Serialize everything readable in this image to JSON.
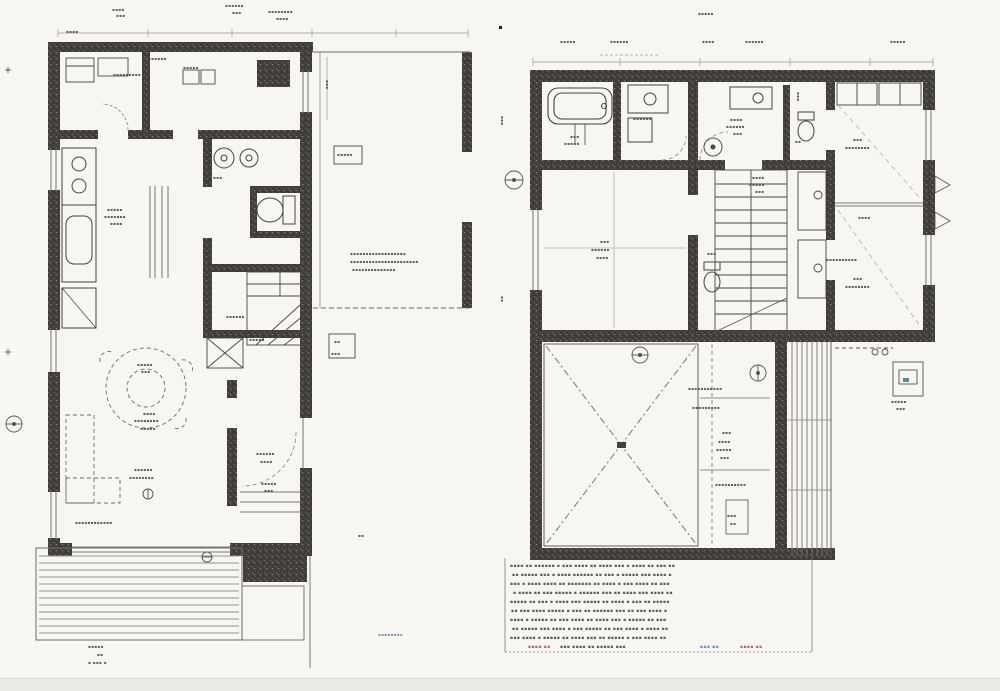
{
  "diagram": {
    "kind": "scanned-architectural-floorplan",
    "plan_count": 2,
    "legible_text": false,
    "left_plan_features": [
      "kitchen-counter",
      "washroom-basins",
      "toilet",
      "winder-stairs",
      "dashed-round-table",
      "sofa",
      "entrance-hall-door-arc",
      "wood-deck",
      "open-carport-bay"
    ],
    "right_plan_features": [
      "bathtub",
      "washstand",
      "hall-basin",
      "wc",
      "tatami-room",
      "straight-stairs",
      "two-bedrooms",
      "closets",
      "void-room-x-brace",
      "balcony-slats",
      "notes-block"
    ]
  },
  "colors": {
    "paper": "#f7f6f2",
    "ink": "#45423e",
    "wall": "#3e3b38",
    "light_line": "#8f8d88",
    "deck_line": "#94928d",
    "note_red": "#a06060",
    "note_blue": "#6b7fae",
    "scan_edge": "#eceae6"
  },
  "illegible_labels": [
    {
      "t": "▪▪▪▪",
      "x": 112,
      "y": 8
    },
    {
      "t": "▪▪▪",
      "x": 116,
      "y": 14
    },
    {
      "t": "▪▪▪▪▪▪",
      "x": 225,
      "y": 4
    },
    {
      "t": "▪▪▪",
      "x": 232,
      "y": 11
    },
    {
      "t": "▪▪▪▪▪▪▪▪",
      "x": 268,
      "y": 10
    },
    {
      "t": "▪▪▪▪",
      "x": 276,
      "y": 17
    },
    {
      "t": "▪▪▪▪",
      "x": 66,
      "y": 30
    },
    {
      "t": "▪▪▪▪▪",
      "x": 70,
      "y": 42
    },
    {
      "t": "▪▪▪▪▪▪",
      "x": 148,
      "y": 57
    },
    {
      "t": "▪▪▪▪▪",
      "x": 183,
      "y": 66
    },
    {
      "t": "▪▪▪▪▪▪▪▪▪",
      "x": 113,
      "y": 73
    },
    {
      "t": "▪▪▪▪▪",
      "x": 107,
      "y": 208
    },
    {
      "t": "▪▪▪▪▪▪▪",
      "x": 104,
      "y": 215
    },
    {
      "t": "▪▪▪▪",
      "x": 110,
      "y": 222
    },
    {
      "t": "▪▪▪",
      "x": 213,
      "y": 176
    },
    {
      "t": "▪▪",
      "x": 250,
      "y": 190
    },
    {
      "t": "▪▪▪▪▪",
      "x": 337,
      "y": 153
    },
    {
      "t": "▪▪▪▪▪▪▪▪▪▪▪▪▪▪▪▪▪▪",
      "x": 350,
      "y": 252
    },
    {
      "t": "▪▪▪▪▪▪▪▪▪▪▪▪▪▪▪▪▪▪▪▪▪▪",
      "x": 350,
      "y": 260
    },
    {
      "t": "▪▪▪▪▪▪▪▪▪▪▪▪▪▪",
      "x": 352,
      "y": 268
    },
    {
      "t": "▪▪▪",
      "x": 329,
      "y": 80,
      "r": 90
    },
    {
      "t": "▪▪",
      "x": 334,
      "y": 340
    },
    {
      "t": "▪▪▪",
      "x": 331,
      "y": 352
    },
    {
      "t": "▪▪▪▪▪▪",
      "x": 226,
      "y": 315
    },
    {
      "t": "▪▪▪▪▪",
      "x": 249,
      "y": 338
    },
    {
      "t": "▪▪▪▪▪",
      "x": 137,
      "y": 363
    },
    {
      "t": "▪▪▪",
      "x": 141,
      "y": 370
    },
    {
      "t": "▪▪▪▪",
      "x": 143,
      "y": 412
    },
    {
      "t": "▪▪▪▪▪▪▪▪",
      "x": 134,
      "y": 419
    },
    {
      "t": "▪▪▪▪▪",
      "x": 140,
      "y": 427
    },
    {
      "t": "▪▪▪▪▪▪",
      "x": 134,
      "y": 468
    },
    {
      "t": "▪▪▪▪▪▪▪▪",
      "x": 129,
      "y": 476
    },
    {
      "t": "▪▪▪▪▪▪",
      "x": 256,
      "y": 452
    },
    {
      "t": "▪▪▪▪",
      "x": 260,
      "y": 460
    },
    {
      "t": "▪▪▪▪▪",
      "x": 261,
      "y": 482
    },
    {
      "t": "▪▪▪",
      "x": 264,
      "y": 489
    },
    {
      "t": "▪▪▪▪▪▪▪▪▪▪▪▪",
      "x": 75,
      "y": 521
    },
    {
      "t": "▪▪",
      "x": 358,
      "y": 534
    },
    {
      "t": "▪▪▪▪▪",
      "x": 88,
      "y": 645
    },
    {
      "t": "▪▪",
      "x": 97,
      "y": 653
    },
    {
      "t": "▪ ▪▪▪ ▪",
      "x": 88,
      "y": 661
    },
    {
      "t": "▪▪▪▪▪▪▪▪",
      "x": 378,
      "y": 633,
      "c": "#7a8aa8"
    },
    {
      "t": "▪▪▪▪▪",
      "x": 560,
      "y": 40
    },
    {
      "t": "▪▪▪▪▪▪",
      "x": 610,
      "y": 40
    },
    {
      "t": "▪▪▪▪▪",
      "x": 698,
      "y": 12
    },
    {
      "t": "▪▪▪▪",
      "x": 702,
      "y": 40
    },
    {
      "t": "▪▪▪▪▪▪",
      "x": 745,
      "y": 40
    },
    {
      "t": "▪▪▪▪▪",
      "x": 890,
      "y": 40
    },
    {
      "t": "▪▪▪",
      "x": 570,
      "y": 135
    },
    {
      "t": "▪▪▪▪▪",
      "x": 564,
      "y": 142
    },
    {
      "t": "▪▪▪▪▪▪",
      "x": 633,
      "y": 117
    },
    {
      "t": "▪▪▪▪",
      "x": 730,
      "y": 118
    },
    {
      "t": "▪▪▪▪▪▪",
      "x": 726,
      "y": 125
    },
    {
      "t": "▪▪▪",
      "x": 733,
      "y": 132
    },
    {
      "t": "▪▪▪",
      "x": 800,
      "y": 92,
      "r": 90
    },
    {
      "t": "▪▪",
      "x": 795,
      "y": 140
    },
    {
      "t": "▪▪▪",
      "x": 853,
      "y": 138
    },
    {
      "t": "▪▪▪▪▪▪▪▪",
      "x": 845,
      "y": 146
    },
    {
      "t": "▪▪▪▪",
      "x": 858,
      "y": 216
    },
    {
      "t": "▪▪▪▪▪▪▪▪▪▪",
      "x": 826,
      "y": 258
    },
    {
      "t": "▪▪▪",
      "x": 853,
      "y": 277
    },
    {
      "t": "▪▪▪▪▪▪▪▪",
      "x": 845,
      "y": 285
    },
    {
      "t": "▪▪▪▪",
      "x": 752,
      "y": 176
    },
    {
      "t": "▪▪▪▪▪",
      "x": 749,
      "y": 183
    },
    {
      "t": "▪▪▪",
      "x": 755,
      "y": 190
    },
    {
      "t": "▪▪▪",
      "x": 707,
      "y": 252
    },
    {
      "t": "▪▪▪",
      "x": 600,
      "y": 240
    },
    {
      "t": "▪▪▪▪▪▪",
      "x": 591,
      "y": 248
    },
    {
      "t": "▪▪▪▪",
      "x": 596,
      "y": 256
    },
    {
      "t": "▪▪▪▪▪▪▪▪▪▪▪",
      "x": 688,
      "y": 387
    },
    {
      "t": "▪▪▪▪▪▪▪▪▪",
      "x": 692,
      "y": 406
    },
    {
      "t": "▪▪▪",
      "x": 722,
      "y": 431
    },
    {
      "t": "▪▪▪▪",
      "x": 718,
      "y": 440
    },
    {
      "t": "▪▪▪▪▪",
      "x": 716,
      "y": 448
    },
    {
      "t": "▪▪▪",
      "x": 720,
      "y": 456
    },
    {
      "t": "▪▪▪▪▪▪▪▪▪▪",
      "x": 715,
      "y": 483
    },
    {
      "t": "▪▪▪",
      "x": 727,
      "y": 514
    },
    {
      "t": "▪▪",
      "x": 730,
      "y": 522
    },
    {
      "t": "▪▪▪▪▪",
      "x": 891,
      "y": 400
    },
    {
      "t": "▪▪▪",
      "x": 896,
      "y": 407
    },
    {
      "t": "▪▪▪",
      "x": 504,
      "y": 116,
      "r": 90
    },
    {
      "t": "▪▪",
      "x": 504,
      "y": 296,
      "r": 90
    },
    {
      "t": "▪▪▪▪ ▪▪ ▪▪▪▪▪▪ ▪ ▪▪▪ ▪▪▪▪ ▪▪ ▪▪▪▪ ▪▪▪ ▪ ▪▪▪▪ ▪▪ ▪▪▪ ▪▪",
      "x": 510,
      "y": 565,
      "s": 4.5
    },
    {
      "t": "▪▪ ▪▪▪▪▪ ▪▪▪ ▪ ▪▪▪▪ ▪▪▪▪▪▪ ▪▪ ▪▪▪ ▪ ▪▪▪▪▪ ▪▪▪ ▪▪▪▪ ▪",
      "x": 512,
      "y": 574,
      "s": 4.5
    },
    {
      "t": "▪▪▪ ▪ ▪▪▪▪ ▪▪▪▪ ▪▪ ▪▪▪▪▪▪▪ ▪▪ ▪▪▪▪ ▪ ▪▪▪ ▪▪▪▪ ▪▪ ▪▪▪",
      "x": 510,
      "y": 583,
      "s": 4.5
    },
    {
      "t": "▪ ▪▪▪▪ ▪▪ ▪▪▪ ▪▪▪▪▪ ▪ ▪▪▪▪▪▪ ▪▪▪ ▪▪ ▪▪▪▪ ▪▪▪ ▪▪▪▪ ▪▪",
      "x": 513,
      "y": 592,
      "s": 4.5
    },
    {
      "t": "▪▪▪▪▪ ▪▪ ▪▪▪ ▪ ▪▪▪▪ ▪▪▪ ▪▪▪▪▪ ▪▪ ▪▪▪▪ ▪ ▪▪▪ ▪▪ ▪▪▪▪▪",
      "x": 510,
      "y": 601,
      "s": 4.5
    },
    {
      "t": "▪▪ ▪▪▪ ▪▪▪▪ ▪▪▪▪▪ ▪ ▪▪▪ ▪▪ ▪▪▪▪▪▪ ▪▪▪ ▪▪ ▪▪▪ ▪▪▪▪ ▪",
      "x": 511,
      "y": 610,
      "s": 4.5
    },
    {
      "t": "▪▪▪▪ ▪ ▪▪▪▪▪ ▪▪ ▪▪▪ ▪▪▪▪ ▪▪ ▪▪▪▪ ▪▪▪ ▪ ▪▪▪▪▪ ▪▪ ▪▪▪",
      "x": 510,
      "y": 619,
      "s": 4.5
    },
    {
      "t": "▪▪ ▪▪▪▪▪ ▪▪▪ ▪▪▪▪ ▪ ▪▪▪ ▪▪▪▪▪ ▪▪ ▪▪▪ ▪▪▪▪ ▪ ▪▪▪▪ ▪▪",
      "x": 512,
      "y": 628,
      "s": 4.5
    },
    {
      "t": "▪▪▪ ▪▪▪▪ ▪ ▪▪▪▪▪ ▪▪ ▪▪▪▪ ▪▪▪ ▪▪ ▪▪▪▪▪ ▪ ▪▪▪ ▪▪▪▪ ▪▪",
      "x": 510,
      "y": 637,
      "s": 4.5
    },
    {
      "t": "▪▪▪▪ ▪▪",
      "x": 528,
      "y": 646,
      "s": 4.5,
      "c": "#a06060"
    },
    {
      "t": "▪▪▪ ▪▪▪▪ ▪▪ ▪▪▪▪▪ ▪▪▪",
      "x": 560,
      "y": 646,
      "s": 4.5
    },
    {
      "t": "▪▪▪ ▪▪",
      "x": 700,
      "y": 646,
      "s": 4.5,
      "c": "#6b7fae"
    },
    {
      "t": "▪▪▪▪ ▪▪",
      "x": 740,
      "y": 646,
      "s": 4.5,
      "c": "#a06060"
    }
  ]
}
